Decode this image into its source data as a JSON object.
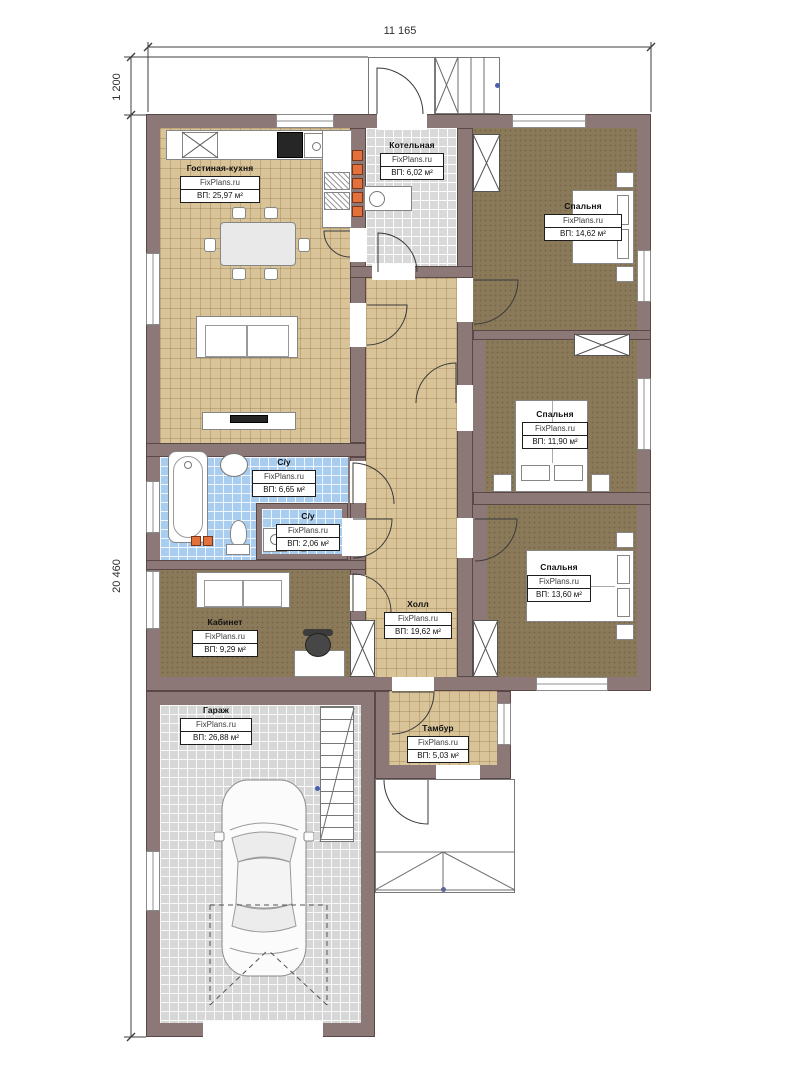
{
  "plan": {
    "title": "Одноэтажный дом — план этажа",
    "watermark": "FixPlans.ru",
    "dimensions": {
      "width_top": "11 165",
      "porch_depth_left": "1 200",
      "height_left": "20 460"
    },
    "rooms": [
      {
        "id": "living-kitchen",
        "name": "Гостиная-кухня",
        "area": "ВП: 25,97 м²"
      },
      {
        "id": "boiler",
        "name": "Котельная",
        "area": "ВП: 6,02 м²"
      },
      {
        "id": "bedroom-1",
        "name": "Спальня",
        "area": "ВП: 14,62 м²"
      },
      {
        "id": "bedroom-2",
        "name": "Спальня",
        "area": "ВП: 11,90 м²"
      },
      {
        "id": "bedroom-3",
        "name": "Спальня",
        "area": "ВП: 13,60 м²"
      },
      {
        "id": "bathroom",
        "name": "С/у",
        "area": "ВП: 6,65 м²"
      },
      {
        "id": "wc",
        "name": "С/у",
        "area": "ВП: 2,06 м²"
      },
      {
        "id": "office",
        "name": "Кабинет",
        "area": "ВП: 9,29 м²"
      },
      {
        "id": "hall",
        "name": "Холл",
        "area": "ВП: 19,62 м²"
      },
      {
        "id": "garage",
        "name": "Гараж",
        "area": "ВП: 26,88 м²"
      },
      {
        "id": "vestibule",
        "name": "Тамбур",
        "area": "ВП: 5,03 м²"
      }
    ],
    "colors": {
      "wall": "#8d7878",
      "floor_wood": "#d9c499",
      "floor_tile_gray": "#d9d9d9",
      "floor_tile_blue": "#a9cdee",
      "floor_carpet": "#8b7a59",
      "vent_orange": "#e2713b",
      "dot_blue": "#4a5fae"
    }
  }
}
